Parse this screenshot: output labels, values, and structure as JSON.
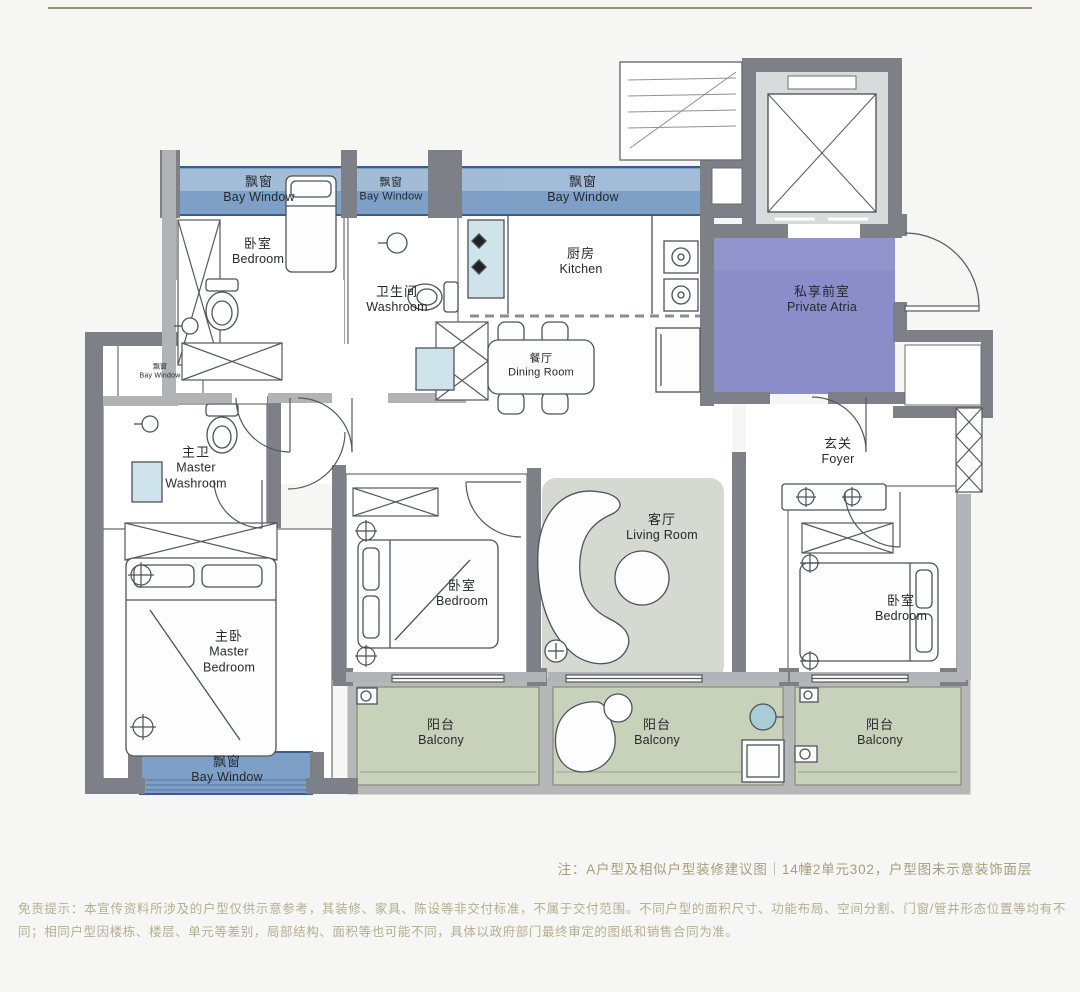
{
  "canvas": {
    "width": 1080,
    "height": 992,
    "background": "#f6f6f5"
  },
  "colors": {
    "bay_window_fill": "#7fa0c6",
    "bay_window_light": "#a9c1d9",
    "bay_window_border": "#3d5c8e",
    "private_atria_fill": "#8a8dc8",
    "balcony_fill": "#c8d2ba",
    "living_rug_fill": "#d6d9d2",
    "wall_dark": "#7d8086",
    "wall_light": "#b1b3b7",
    "fixture_blue": "#cfe3ea",
    "note_text": "#a89e7b",
    "disclaimer_text": "#b6ae90",
    "top_rule": "#9a9371"
  },
  "rooms": {
    "bay_window_top_left": {
      "zh": "飘窗",
      "en": "Bay Window"
    },
    "bay_window_top_mid": {
      "zh": "飘窗",
      "en": "Bay Window"
    },
    "bay_window_kitchen": {
      "zh": "飘窗",
      "en": "Bay Window"
    },
    "bay_window_left_small": {
      "zh": "飘窗",
      "en": "Bay Window"
    },
    "bay_window_master": {
      "zh": "飘窗",
      "en": "Bay Window"
    },
    "bedroom_top_left": {
      "zh": "卧室",
      "en": "Bedroom"
    },
    "washroom": {
      "zh": "卫生间",
      "en": "Washroom"
    },
    "kitchen": {
      "zh": "厨房",
      "en": "Kitchen"
    },
    "dining_room": {
      "zh": "餐厅",
      "en": "Dining Room"
    },
    "private_atria": {
      "zh": "私享前室",
      "en": "Private Atria"
    },
    "foyer": {
      "zh": "玄关",
      "en": "Foyer"
    },
    "living_room": {
      "zh": "客厅",
      "en": "Living Room"
    },
    "bedroom_middle": {
      "zh": "卧室",
      "en": "Bedroom"
    },
    "bedroom_right": {
      "zh": "卧室",
      "en": "Bedroom"
    },
    "master_washroom": {
      "zh": "主卫",
      "en": "Master Washroom"
    },
    "master_bedroom": {
      "zh": "主卧",
      "en": "Master Bedroom"
    },
    "balcony_left": {
      "zh": "阳台",
      "en": "Balcony"
    },
    "balcony_middle": {
      "zh": "阳台",
      "en": "Balcony"
    },
    "balcony_right": {
      "zh": "阳台",
      "en": "Balcony"
    }
  },
  "notes": {
    "plan_note": "注：A户型及相似户型装修建议图｜14幢2单元302，户型图未示意装饰面层",
    "disclaimer": "免责提示：本宣传资料所涉及的户型仅供示意参考，其装修、家具、陈设等非交付标准，不属于交付范围。不同户型的面积尺寸、功能布局、空间分割、门窗/管井形态位置等均有不同；相同户型因楼栋、楼层、单元等差别，局部结构、面积等也可能不同，具体以政府部门最终审定的图纸和销售合同为准。"
  }
}
